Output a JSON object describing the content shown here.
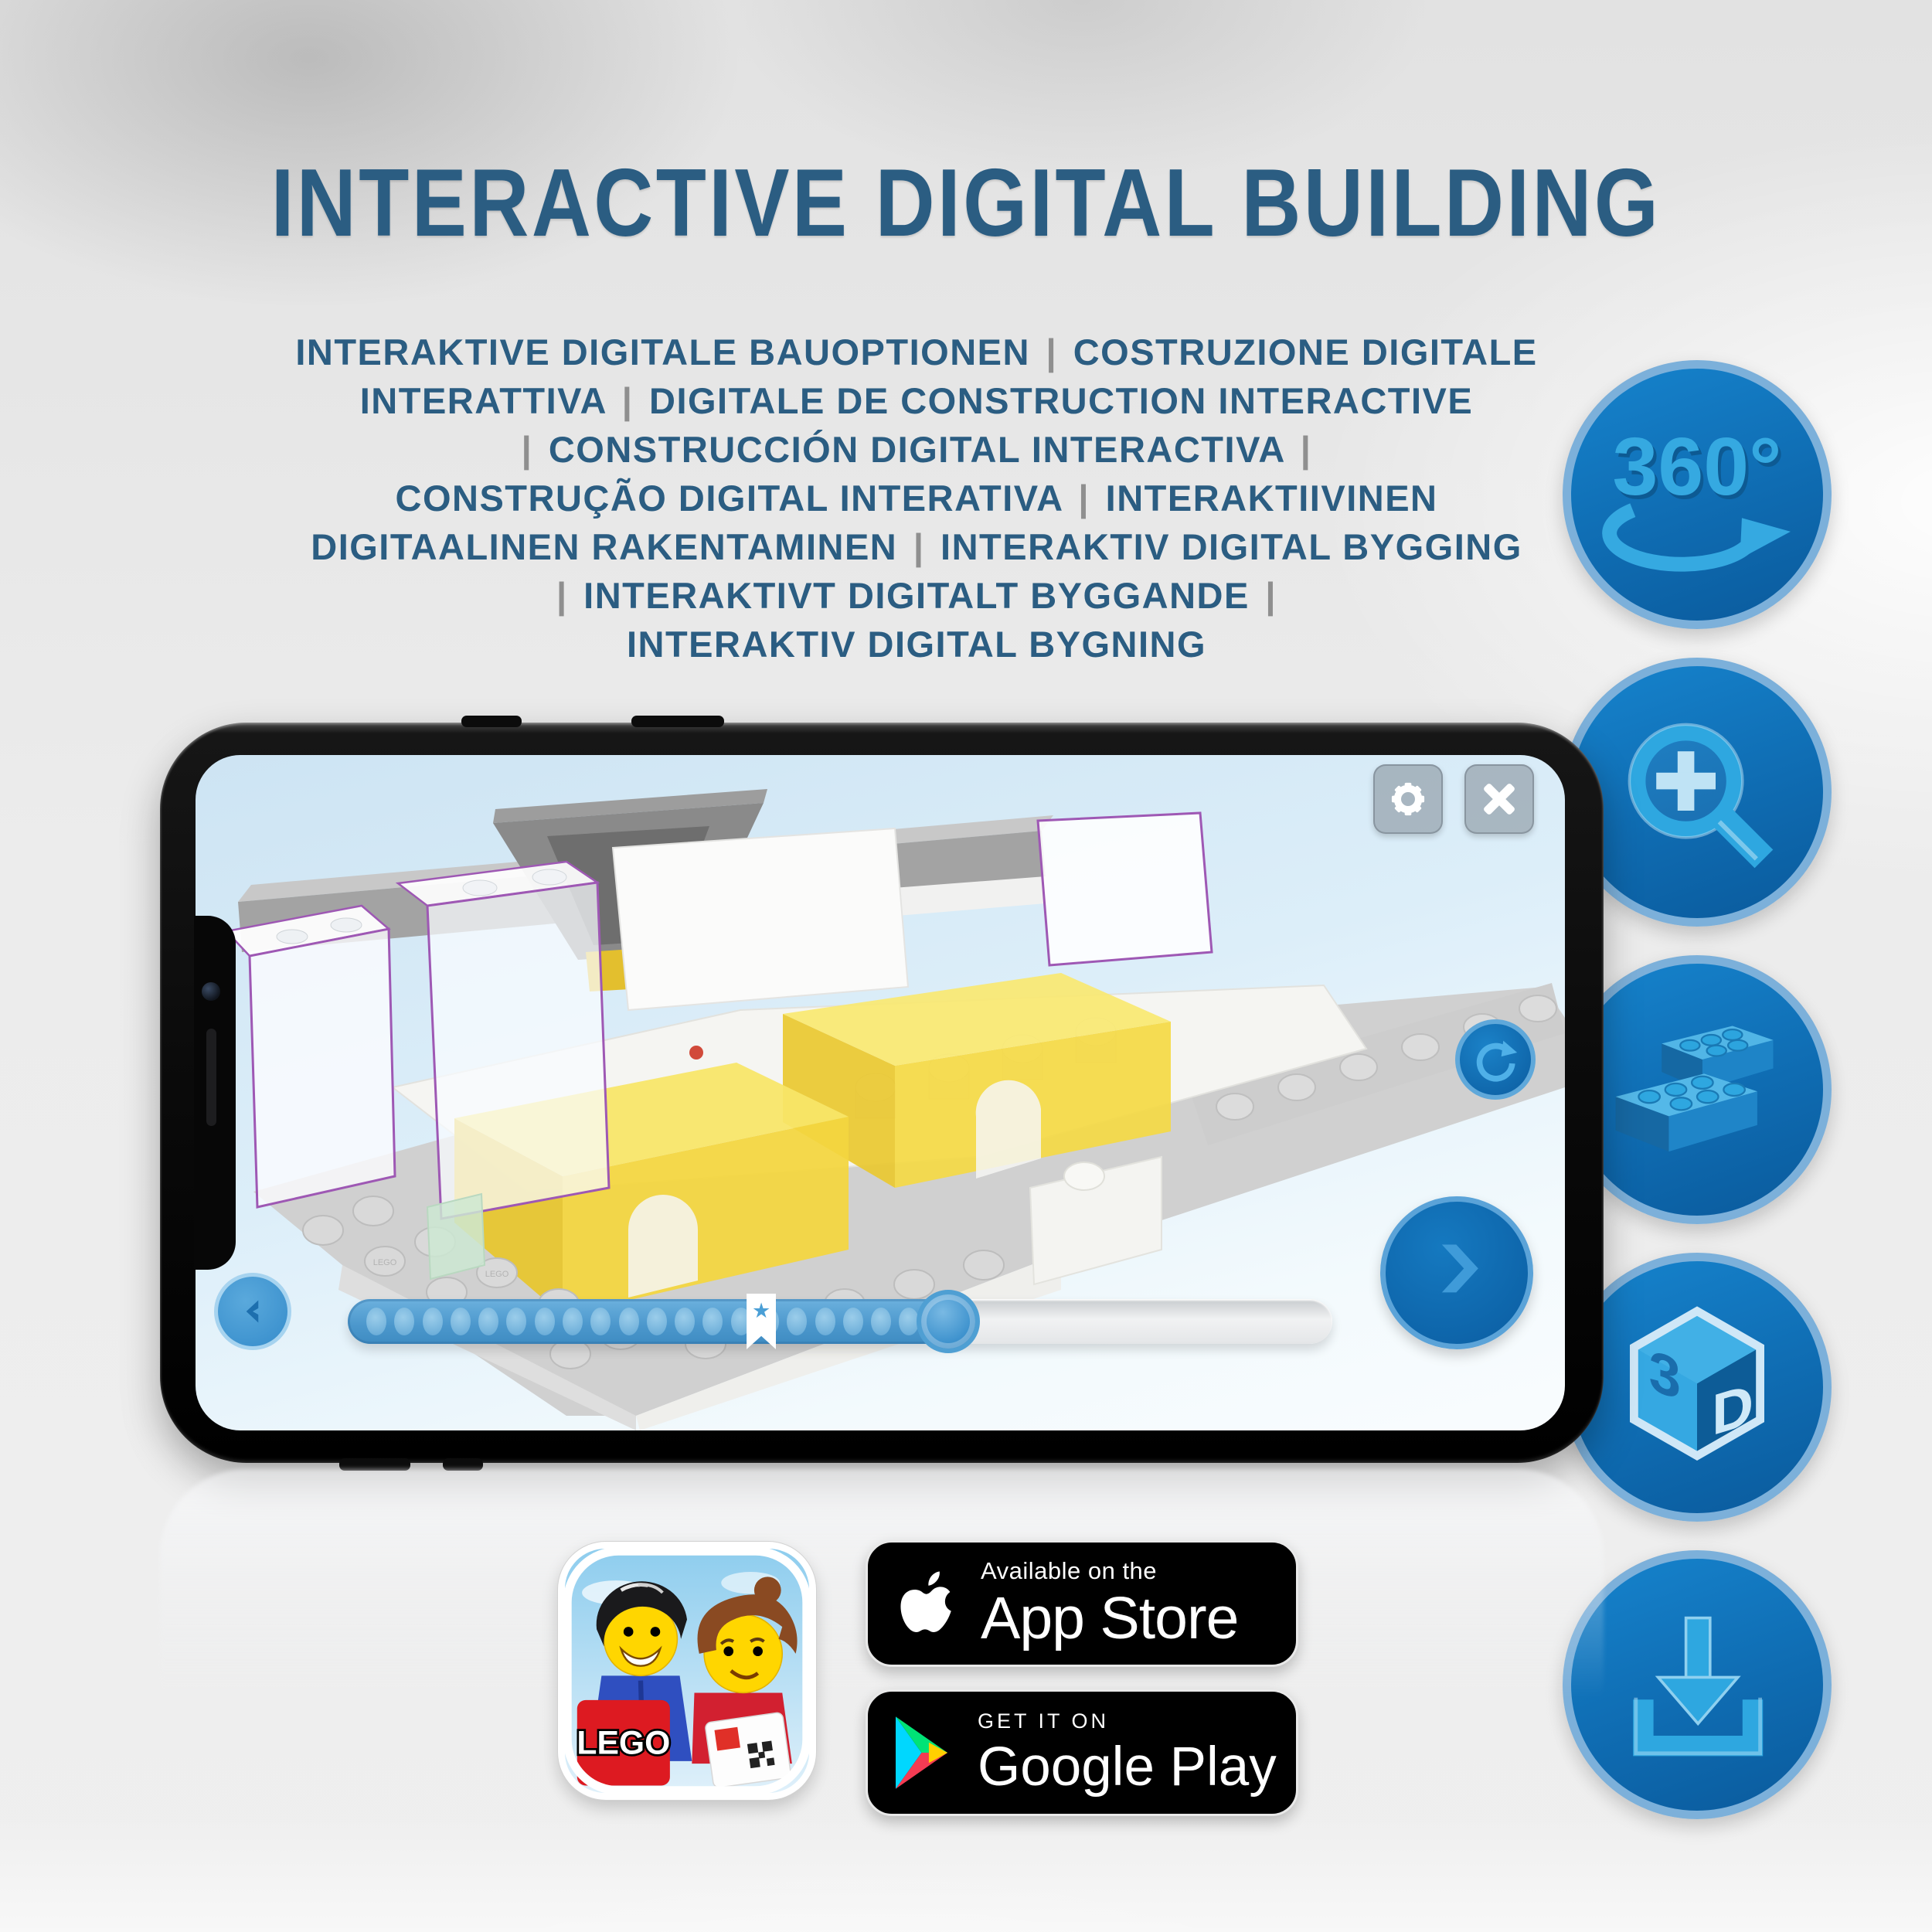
{
  "header": {
    "title": "INTERACTIVE DIGITAL BUILDING"
  },
  "subtitle": {
    "lines": [
      "INTERAKTIVE DIGITALE BAUOPTIONEN | COSTRUZIONE DIGITALE",
      "INTERATTIVA | DIGITALE DE CONSTRUCTION INTERACTIVE",
      "| CONSTRUCCIÓN DIGITAL INTERACTIVA |",
      "CONSTRUÇÃO DIGITAL INTERATIVA | INTERAKTIIVINEN",
      "DIGITAALINEN RAKENTAMINEN | INTERAKTIV DIGITAL BYGGING",
      "| INTERAKTIVT DIGITALT BYGGANDE |",
      "INTERAKTIV DIGITAL BYGNING"
    ]
  },
  "features": [
    {
      "name": "360-rotation-icon",
      "label": "360°"
    },
    {
      "name": "zoom-in-icon"
    },
    {
      "name": "brick-icon"
    },
    {
      "name": "3d-view-icon",
      "left": "3",
      "right": "D"
    },
    {
      "name": "download-icon"
    }
  ],
  "phone": {
    "scene": {
      "stud_text": "LEGO"
    },
    "app": {
      "progress": {
        "dots": 20,
        "filled_pct": 64,
        "bookmark_pct": 42,
        "handle_pct": 61,
        "bookmark_star": "★"
      }
    }
  },
  "badges": {
    "lego_app": {
      "logo_text": "LEGO"
    },
    "app_store": {
      "tagline": "Available on the",
      "name": "App Store"
    },
    "google_play": {
      "tagline": "GET IT ON",
      "name": "Google Play"
    }
  },
  "colors": {
    "headline_blue": "#2b5d82",
    "separator_gray": "#8f8f8f",
    "icon_circle_blue": "#0f6cb2",
    "icon_ring_blue": "#7cb0da",
    "icon_glyph_blue": "#2ea7e0",
    "app_yellow_brick": "#f3d640",
    "app_outline_purple": "#9e58b4",
    "progress_fill_blue": "#4b97cc",
    "badge_black": "#000000"
  }
}
